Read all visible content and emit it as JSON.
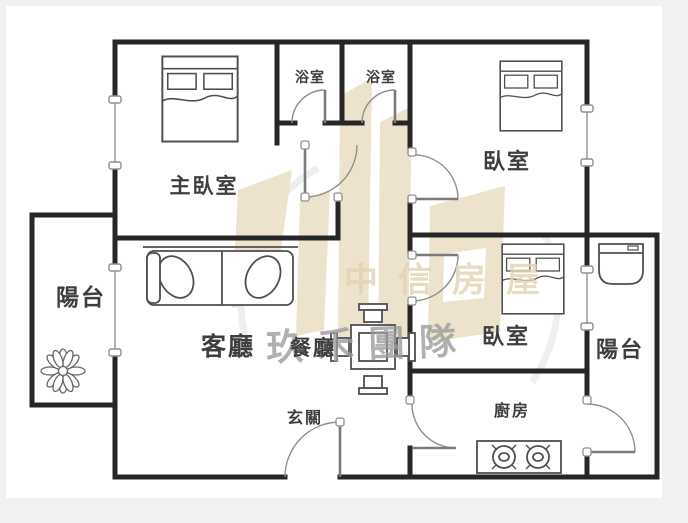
{
  "plan_title": "apartment-floor-plan",
  "rooms": {
    "master_bedroom": {
      "label": "主臥室"
    },
    "bathroom_1": {
      "label": "浴室"
    },
    "bathroom_2": {
      "label": "浴室"
    },
    "bedroom_top_right": {
      "label": "臥室"
    },
    "bedroom_mid_right": {
      "label": "臥室"
    },
    "living_room": {
      "label": "客廳"
    },
    "dining_room": {
      "label": "餐廳"
    },
    "entry": {
      "label": "玄關"
    },
    "kitchen": {
      "label": "廚房"
    },
    "balcony_left": {
      "label": "陽台"
    },
    "balcony_right": {
      "label": "陽台"
    }
  },
  "watermark": {
    "brand_text": "中信房屋",
    "team_text": "玖禾團隊",
    "logo_color": "#e9dcc0",
    "brand_text_color": "#e2d3b2",
    "team_text_color": "#9d9d9d"
  },
  "colors": {
    "wall": "#262626",
    "furniture_line": "#4f4f4f",
    "door_line": "#8f8f8f",
    "window_line": "#9f9f9f",
    "paper": "#ffffff",
    "page_background": "#f1f1f1"
  }
}
